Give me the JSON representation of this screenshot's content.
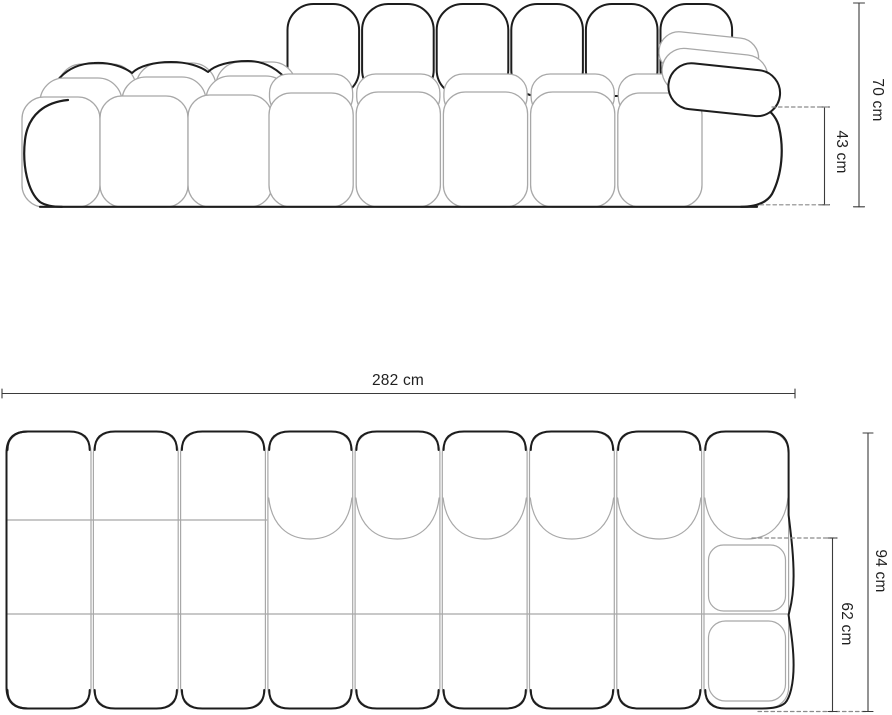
{
  "drawing": {
    "type": "furniture-dimension-diagram",
    "subject": "modular bubble sofa, front elevation and top plan views",
    "unit": "cm",
    "colors": {
      "outline_dark": "#1d1d1d",
      "outline_light": "#a8a8a8",
      "dimension_line": "#3b3b3b",
      "dashed_line": "#8a8a8a",
      "text": "#1f1f1f",
      "background": "#ffffff"
    },
    "elevation": {
      "height_total": {
        "label": "70 cm",
        "value": 70,
        "unit": "cm"
      },
      "height_seat": {
        "label": "43 cm",
        "value": 43,
        "unit": "cm"
      }
    },
    "plan": {
      "width_total": {
        "label": "282 cm",
        "value": 282,
        "unit": "cm"
      },
      "depth_total": {
        "label": "94 cm",
        "value": 94,
        "unit": "cm"
      },
      "depth_seat": {
        "label": "62 cm",
        "value": 62,
        "unit": "cm"
      }
    }
  }
}
